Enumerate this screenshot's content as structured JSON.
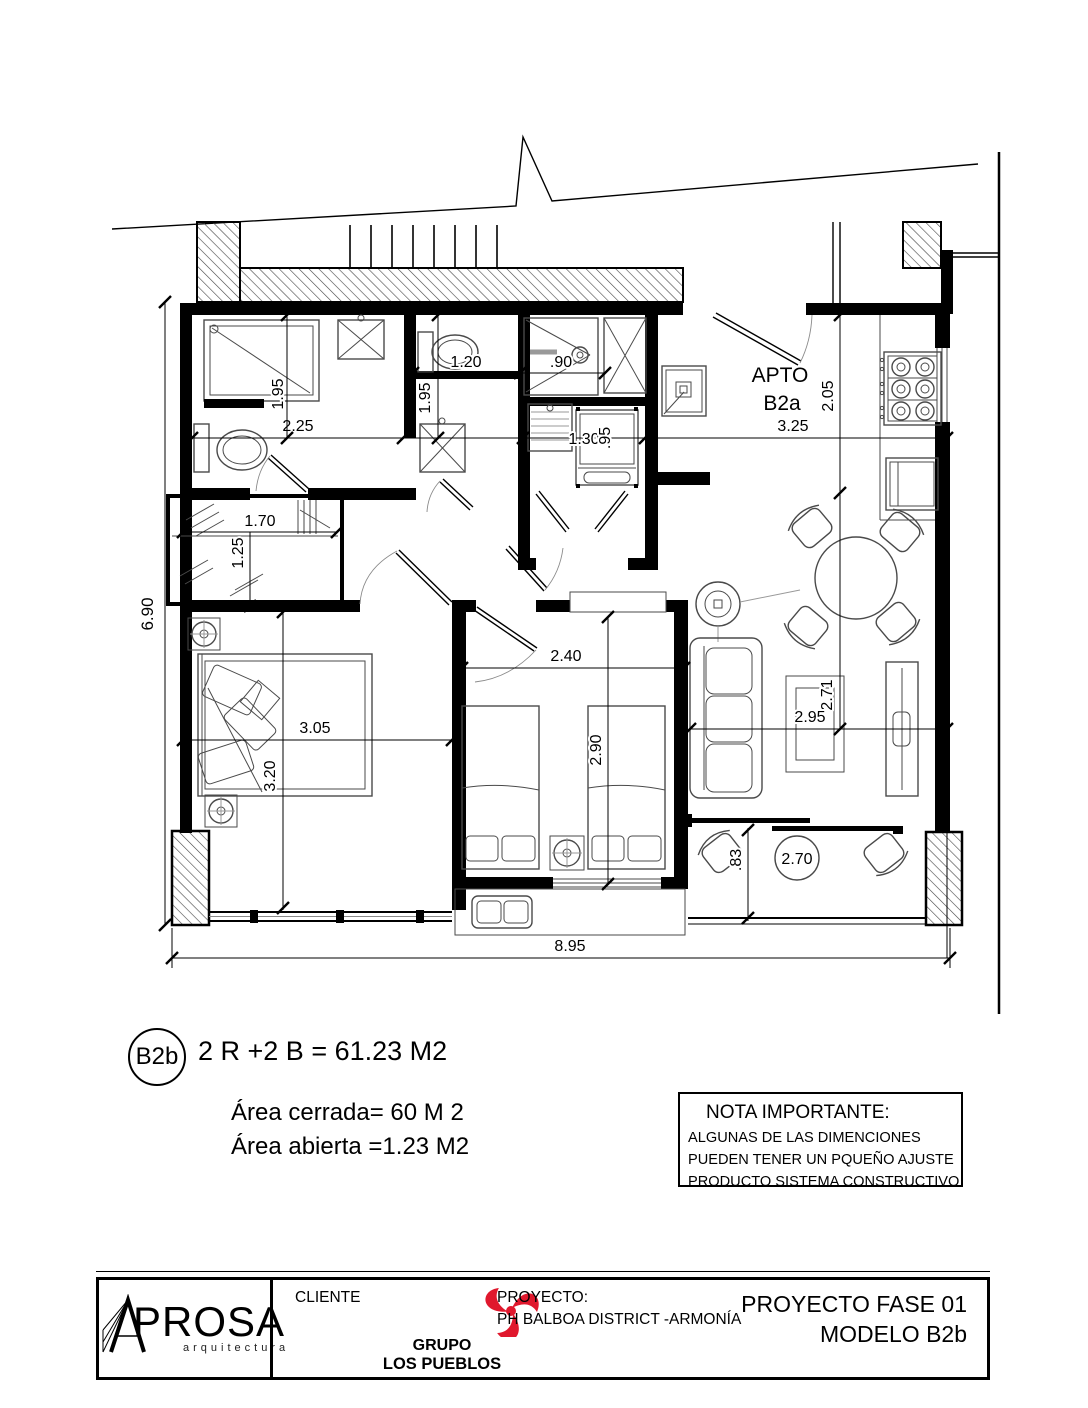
{
  "plan": {
    "unit_label": {
      "line1": "APTO",
      "line2": "B2a"
    },
    "dims": {
      "bath1_height": "1.95",
      "bath1_width": "2.25",
      "wc_width": "1.20",
      "shower_width": ".90",
      "bath2_height": "1.95",
      "laundry_width": "1.30",
      "laundry_depth": ".95",
      "kitchen_width": "3.25",
      "kitchen_depth": "2.05",
      "closet_width": "1.70",
      "closet_depth": "1.25",
      "side_total": "6.90",
      "bed1_width": "3.05",
      "bed1_depth": "3.20",
      "bed2_width": "2.40",
      "bed2_depth": "2.90",
      "living_width": "2.95",
      "living_depth": "2.71",
      "balcony_depth": ".83",
      "balcony_table": "2.70",
      "total_width": "8.95"
    }
  },
  "summary": {
    "badge": "B2b",
    "formula": "2 R +2 B = 61.23 M2",
    "area_closed": "Área cerrada= 60 M 2",
    "area_open": "Área abierta =1.23 M2"
  },
  "note": {
    "title": "NOTA IMPORTANTE:",
    "line1": "ALGUNAS DE LAS DIMENCIONES",
    "line2": "PUEDEN TENER UN PQUEÑO AJUSTE",
    "line3": "PRODUCTO SISTEMA CONSTRUCTIVO"
  },
  "titleblock": {
    "firm": "PROSA",
    "firm_sub": "arquitectura",
    "client_label": "CLIENTE",
    "client_line1": "GRUPO",
    "client_line2": "LOS PUEBLOS",
    "project_label": "PROYECTO:",
    "project_name": "PH BALBOA DISTRICT -ARMONÍA",
    "phase": "PROYECTO FASE 01",
    "model": "MODELO B2b"
  },
  "colors": {
    "brand_red": "#e0182d",
    "ink": "#000000"
  }
}
